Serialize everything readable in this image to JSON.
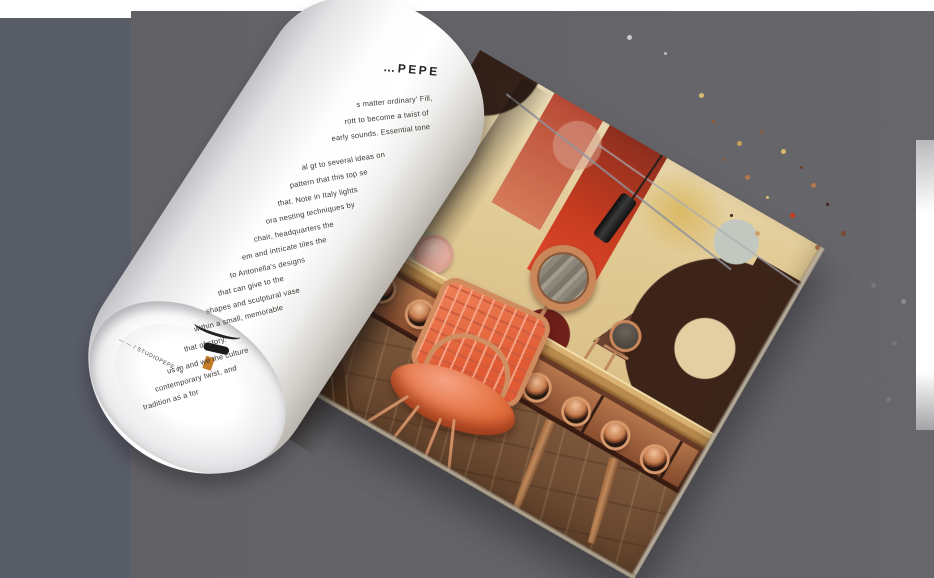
{
  "left_page": {
    "heading": "…PEPE",
    "body_lines": [
      "s matter ordinary' Fill,",
      "rott to become a twist of",
      "early sounds. Essential tone",
      "al gt to several ideas on",
      "pattern that this top se",
      "that. Note in Italy lights",
      "ora nesting techniques by",
      "chair, headquarters the",
      "em and intricate tiles the",
      "to Antonella's designs",
      "that can give to the",
      "shapes and sculptural vase",
      "within a small, memorable",
      "that of story.",
      "us in and we the culture",
      "contemporary twist, and",
      "tradition as a for"
    ],
    "edge_text": "—  — / STUDIOPEPE Ca"
  },
  "colors": {
    "background_left": "#595d68",
    "background_right": "#67676b",
    "page_white": "#ffffff",
    "chair_coral": "#e8714f",
    "copper": "#c9875a",
    "wall_cream": "#e6d4a8",
    "wall_red": "#c63b1f",
    "wall_dark_brown": "#3c2419",
    "carpet_brown": "#6f4d33",
    "wood_floor": "#4e3120",
    "desk_wood": "#b98a4e"
  }
}
